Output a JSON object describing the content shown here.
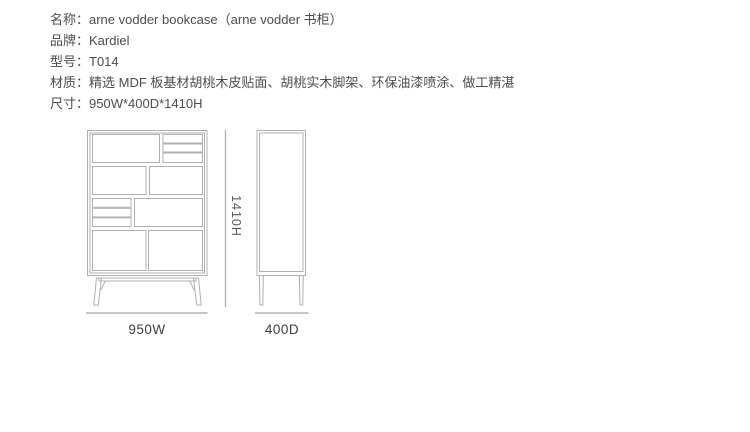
{
  "info": {
    "lines": [
      {
        "label": "名称",
        "text": "名称：arne vodder bookcase（arne vodder 书柜）"
      },
      {
        "label": "品牌",
        "text": "品牌：Kardiel"
      },
      {
        "label": "型号",
        "text": "型号：T014"
      },
      {
        "label": "材质",
        "text": "材质：精选 MDF 板基材胡桃木皮贴面、胡桃实木脚架、环保油漆喷涂、做工精湛"
      },
      {
        "label": "尺寸",
        "text": "尺寸：950W*400D*1410H"
      }
    ],
    "product": {
      "name_en": "arne vodder bookcase",
      "name_cn": "arne vodder 书柜",
      "brand": "Kardiel",
      "model": "T014",
      "material": "精选 MDF 板基材胡桃木皮贴面、胡桃实木脚架、环保油漆喷涂、做工精湛",
      "dimensions": "950W*400D*1410H"
    }
  },
  "drawing": {
    "front_view": {
      "name": "bookcase-front-elevation",
      "width_label": "950W",
      "height_label": "1410H"
    },
    "side_view": {
      "name": "bookcase-side-elevation",
      "depth_label": "400D"
    },
    "colors": {
      "cabinet_line": "#b0b0b0",
      "dimension_line": "#b3b3b3",
      "dimension_label_text": "#3f3f3f",
      "height_label_text": "#5a5a5a",
      "info_text": "#4d4d4d",
      "background": "#ffffff"
    }
  }
}
